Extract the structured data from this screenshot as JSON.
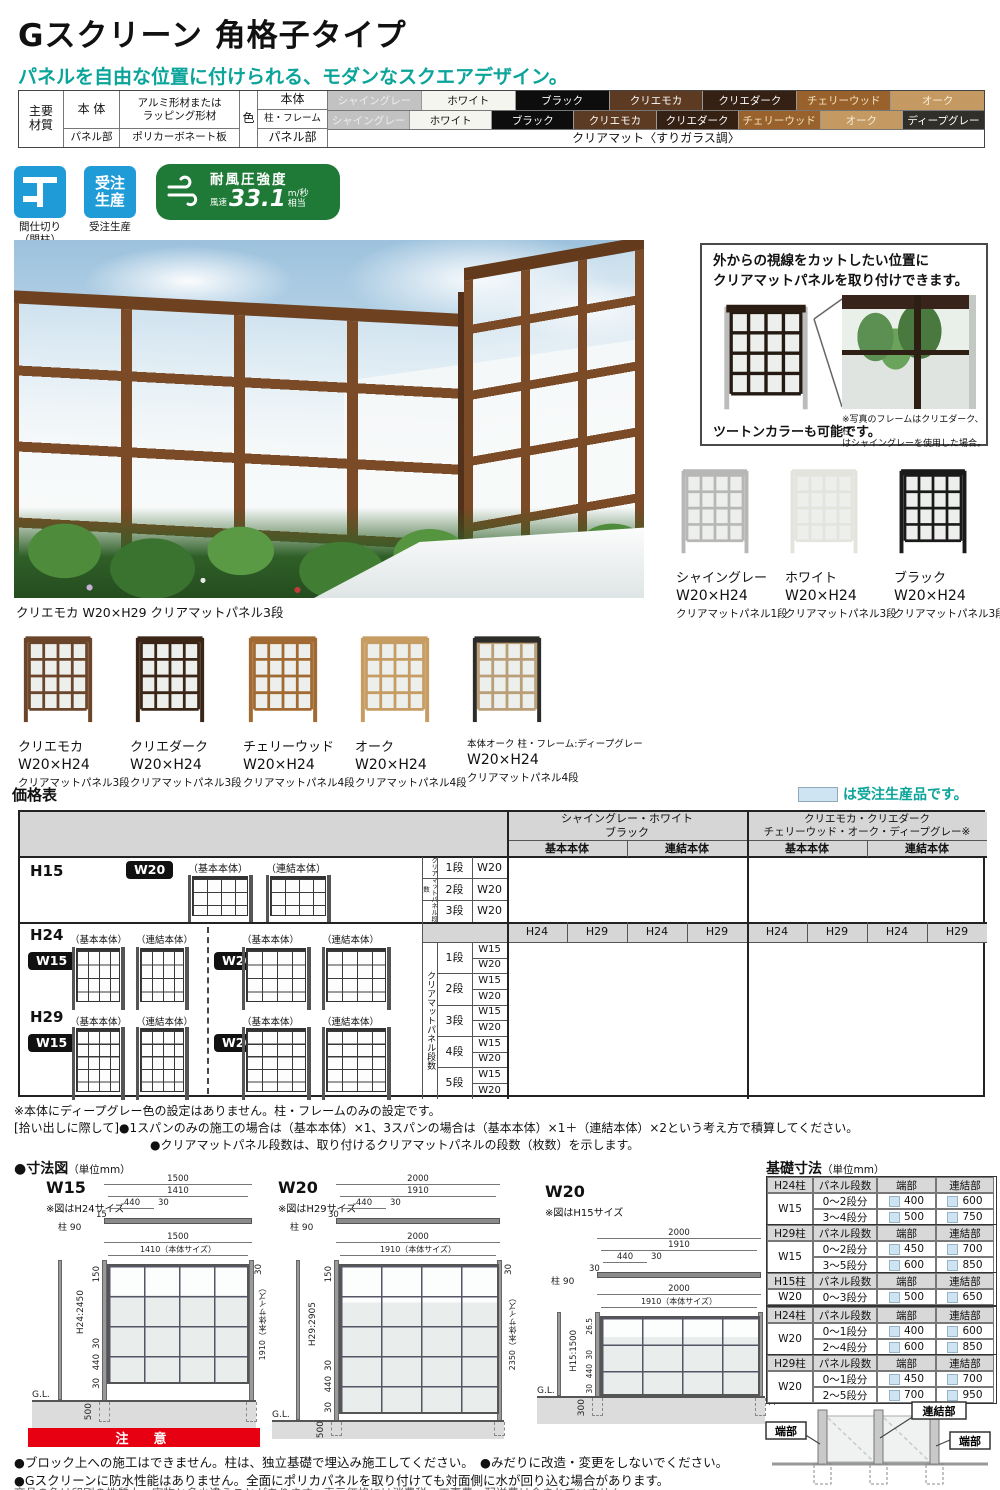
{
  "header": {
    "title": "Gスクリーン 角格子タイプ",
    "subtitle": "パネルを自由な位置に付けられる、モダンなスクエアデザイン。"
  },
  "spec": {
    "material_label": "主要\n材質",
    "rows": [
      {
        "label": "本 体",
        "value": "アルミ形材または\nラッピング形材"
      },
      {
        "label": "パネル部",
        "value": "ポリカーボネート板"
      }
    ],
    "color_label": "色",
    "body_row_label": "本体",
    "frame_row_label": "柱・フレーム",
    "panel_row_label": "パネル部",
    "panel_value": "クリアマット〈すりガラス調〉",
    "body_colors": [
      {
        "name": "シャイングレー",
        "bg": "#c2c2c2",
        "fg": "#ededed"
      },
      {
        "name": "ホワイト",
        "bg": "#f5f5f0",
        "fg": "#111111"
      },
      {
        "name": "ブラック",
        "bg": "#0d0d0d",
        "fg": "#ffffff"
      },
      {
        "name": "クリエモカ",
        "bg": "#5d3a22",
        "fg": "#ffffff"
      },
      {
        "name": "クリエダーク",
        "bg": "#352014",
        "fg": "#ffffff"
      },
      {
        "name": "チェリーウッド",
        "bg": "#99622c",
        "fg": "#f5e3c0"
      },
      {
        "name": "オーク",
        "bg": "#c49a62",
        "fg": "#f8efdb"
      }
    ],
    "frame_colors": [
      {
        "name": "シャイングレー",
        "bg": "#c2c2c2",
        "fg": "#ededed"
      },
      {
        "name": "ホワイト",
        "bg": "#f5f5f0",
        "fg": "#111111"
      },
      {
        "name": "ブラック",
        "bg": "#0d0d0d",
        "fg": "#ffffff"
      },
      {
        "name": "クリエモカ",
        "bg": "#5d3a22",
        "fg": "#ffffff"
      },
      {
        "name": "クリエダーク",
        "bg": "#352014",
        "fg": "#ffffff"
      },
      {
        "name": "チェリーウッド",
        "bg": "#99622c",
        "fg": "#f5e3c0"
      },
      {
        "name": "オーク",
        "bg": "#c49a62",
        "fg": "#f8efdb"
      },
      {
        "name": "ディープグレー",
        "bg": "#312f2a",
        "fg": "#ffffff"
      }
    ]
  },
  "badges": {
    "partition_label": "間仕切り\n（間柱）",
    "order_icon": "受注\n生産",
    "order_label": "受注生産",
    "wind_title": "耐風圧強度",
    "wind_prefix": "風速",
    "wind_value": "33.1",
    "wind_unit": "m/秒",
    "wind_suffix": "相当"
  },
  "hero": {
    "caption": "クリエモカ W20×H29 クリアマットパネル3段"
  },
  "info_box": {
    "heading": "外からの視線をカットしたい位置に\nクリアマットパネルを取り付けできます。",
    "two_tone": "ツートンカラーも可能です。",
    "note": "※写真のフレームはクリエダーク、柱\nはシャイングレーを使用した場合。",
    "fence": {
      "cap": "#2c1d12",
      "grid": "#241a12",
      "post": "#bcbcbc"
    }
  },
  "variations": [
    {
      "name": "シャイングレー",
      "size": "W20×H24",
      "panel": "クリアマットパネル1段",
      "grid": "#b7b7b5",
      "post": "#b7b7b5",
      "cap": "#b7b7b5"
    },
    {
      "name": "ホワイト",
      "size": "W20×H24",
      "panel": "クリアマットパネル3段",
      "grid": "#e4e4de",
      "post": "#e4e4de",
      "cap": "#e4e4de"
    },
    {
      "name": "ブラック",
      "size": "W20×H24",
      "panel": "クリアマットパネル3段",
      "grid": "#1a1a1a",
      "post": "#1a1a1a",
      "cap": "#1a1a1a"
    },
    {
      "name": "クリエモカ",
      "size": "W20×H24",
      "panel": "クリアマットパネル3段",
      "grid": "#6b4529",
      "post": "#6b4529",
      "cap": "#6b4529"
    },
    {
      "name": "クリエダーク",
      "size": "W20×H24",
      "panel": "クリアマットパネル3段",
      "grid": "#3a2517",
      "post": "#3a2517",
      "cap": "#3a2517"
    },
    {
      "name": "チェリーウッド",
      "size": "W20×H24",
      "panel": "クリアマットパネル4段",
      "grid": "#a26a33",
      "post": "#a26a33",
      "cap": "#a26a33"
    },
    {
      "name": "オーク",
      "size": "W20×H24",
      "panel": "クリアマットパネル4段",
      "grid": "#c69c63",
      "post": "#c69c63",
      "cap": "#c69c63"
    },
    {
      "name": "本体オーク 柱・フレーム:ディープグレー",
      "size": "W20×H24",
      "panel": "クリアマットパネル4段",
      "grid": "#b99e77",
      "post": "#2e2c28",
      "cap": "#2e2c28"
    }
  ],
  "price": {
    "heading": "価格表",
    "legend": "は受注生産品です。",
    "group1": "シャイングレー・ホワイト\nブラック",
    "group2": "クリエモカ・クリエダーク\nチェリーウッド・オーク・ディープグレー※",
    "sub_basic": "基本本体",
    "sub_link": "連結本体",
    "basic_label": "（基本本体）",
    "link_label": "（連結本体）",
    "h15": "H15",
    "h24": "H24",
    "h29": "H29",
    "w15_badge": "W15",
    "w20_badge": "W20",
    "dan_label": "クリアマットパネル段数",
    "h15_rows": [
      {
        "dan": "1段",
        "w": "W20"
      },
      {
        "dan": "2段",
        "w": "W20"
      },
      {
        "dan": "3段",
        "w": "W20"
      }
    ],
    "h_sub": [
      "H24",
      "H29",
      "H24",
      "H29",
      "H24",
      "H29",
      "H24",
      "H29"
    ],
    "dans": [
      "1段",
      "2段",
      "3段",
      "4段",
      "5段"
    ],
    "w_rows": [
      "W15",
      "W20",
      "W15",
      "W20",
      "W15",
      "W20",
      "W15",
      "W20",
      "W15",
      "W20"
    ]
  },
  "notes": [
    "※本体にディープグレー色の設定はありません。柱・フレームのみの設定です。",
    "[拾い出しに際して]●1スパンのみの施工の場合は（基本本体）×1、3スパンの場合は（基本本体）×1＋（連結本体）×2という考え方で積算してください。",
    "●クリアマットパネル段数は、取り付けるクリアマットパネルの段数（枚数）を示します。"
  ],
  "dims": {
    "heading": "●寸法図",
    "unit": "（単位mm）",
    "d1": {
      "name": "W15",
      "note": "※図はH24サイズ",
      "pt": "1500",
      "pi": "1410",
      "p440": "440",
      "p30": "30",
      "pe": "15",
      "post": "柱 90",
      "ft": "1500",
      "fi": "1410（本体サイズ）",
      "rtop": "30",
      "rb": "1910（本体サイズ）",
      "l1": "150",
      "lh": "H24:2450",
      "l30a": "30",
      "l440": "440",
      "l30b": "30",
      "gl": "G.L.",
      "depth": "500"
    },
    "d2": {
      "name": "W20",
      "note": "※図はH29サイズ",
      "pt": "2000",
      "pi": "1910",
      "p440": "440",
      "p30": "30",
      "pe": "30",
      "post": "柱 90",
      "ft": "2000",
      "fi": "1910（本体サイズ）",
      "rtop": "30",
      "rb": "2350（本体サイズ）",
      "l1": "150",
      "lh": "H29:2905",
      "l30a": "30",
      "l440": "440",
      "l30b": "30",
      "gl": "G.L.",
      "depth": "500"
    },
    "d3": {
      "name": "W20",
      "note": "※図はH15サイズ",
      "pt": "2000",
      "pi": "1910",
      "p440": "440",
      "p30": "30",
      "pe": "30",
      "post": "柱 90",
      "ft": "2000",
      "fi": "1910（本体サイズ）",
      "rtop": "",
      "rb": "1436.5（本体サイズ）",
      "l1": "26.5",
      "lh": "H15:1500",
      "l30a": "30",
      "l440": "440",
      "l30b": "30",
      "gl": "G.L.",
      "depth": "300"
    }
  },
  "foundation": {
    "heading": "基礎寸法",
    "unit": "（単位mm）",
    "col_dan": "パネル段数",
    "col_end": "端部",
    "col_link": "連結部",
    "tables": [
      {
        "post": "H24柱",
        "w": "W15",
        "rows": [
          {
            "dan": "0〜2段分",
            "end": "400",
            "link": "600"
          },
          {
            "dan": "3〜4段分",
            "end": "500",
            "link": "750"
          }
        ]
      },
      {
        "post": "H29柱",
        "w": "W15",
        "rows": [
          {
            "dan": "0〜2段分",
            "end": "450",
            "link": "700"
          },
          {
            "dan": "3〜5段分",
            "end": "600",
            "link": "850"
          }
        ]
      },
      {
        "post": "H15柱",
        "w": "W20",
        "rows": [
          {
            "dan": "0〜3段分",
            "end": "500",
            "link": "650"
          }
        ]
      },
      {
        "post": "H24柱",
        "w": "W20",
        "rows": [
          {
            "dan": "0〜1段分",
            "end": "400",
            "link": "600"
          },
          {
            "dan": "2〜4段分",
            "end": "600",
            "link": "850"
          }
        ]
      },
      {
        "post": "H29柱",
        "w": "W20",
        "rows": [
          {
            "dan": "0〜1段分",
            "end": "450",
            "link": "700"
          },
          {
            "dan": "2〜5段分",
            "end": "700",
            "link": "950"
          }
        ]
      }
    ],
    "diagram": {
      "left": "端部",
      "center": "連結部",
      "right": "端部"
    }
  },
  "caution": {
    "heading": "注　意",
    "lines": [
      "●ブロック上への施工はできません。柱は、独立基礎で埋込み施工してください。　●みだりに改造・変更をしないでください。",
      "●Gスクリーンに防水性能はありません。全面にポリカパネルを取り付けても対面側に水が回り込む場合があります。"
    ],
    "footer": "商品の色は印刷の性質上、実物と多少違うことがあります。表示価格には消費税、工事費、配送費は含まれていません。"
  }
}
